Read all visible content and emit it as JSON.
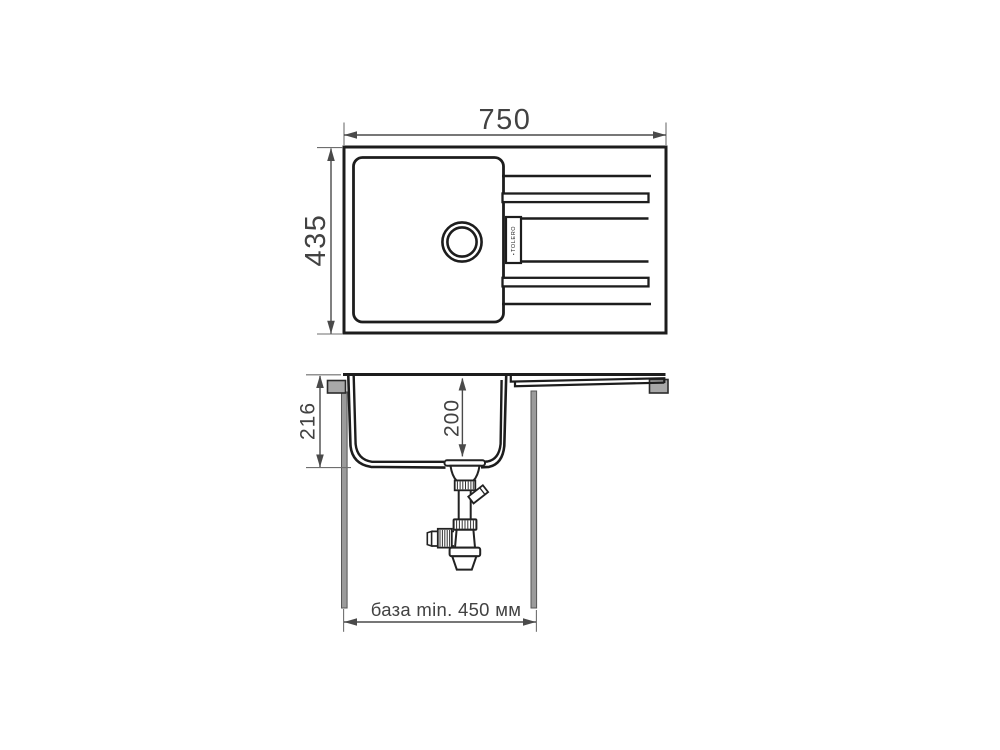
{
  "drawing": {
    "title": "sink-dimensional-drawing",
    "brand": "TOLERO",
    "icons": {
      "brand_logo": "▪"
    },
    "top_view": {
      "width_label": "750",
      "height_label": "435"
    },
    "section_view": {
      "total_depth_label": "216",
      "bowl_depth_label": "200",
      "base_label": "база min. 450 мм"
    },
    "colors": {
      "background": "#ffffff",
      "outline": "#1d1d1d",
      "dimension": "#4a4a4a",
      "extension": "#6e6e6e",
      "text": "#424242",
      "gray_fill": "#9b9b9b",
      "clamp_fill": "#a8a8a8"
    }
  }
}
